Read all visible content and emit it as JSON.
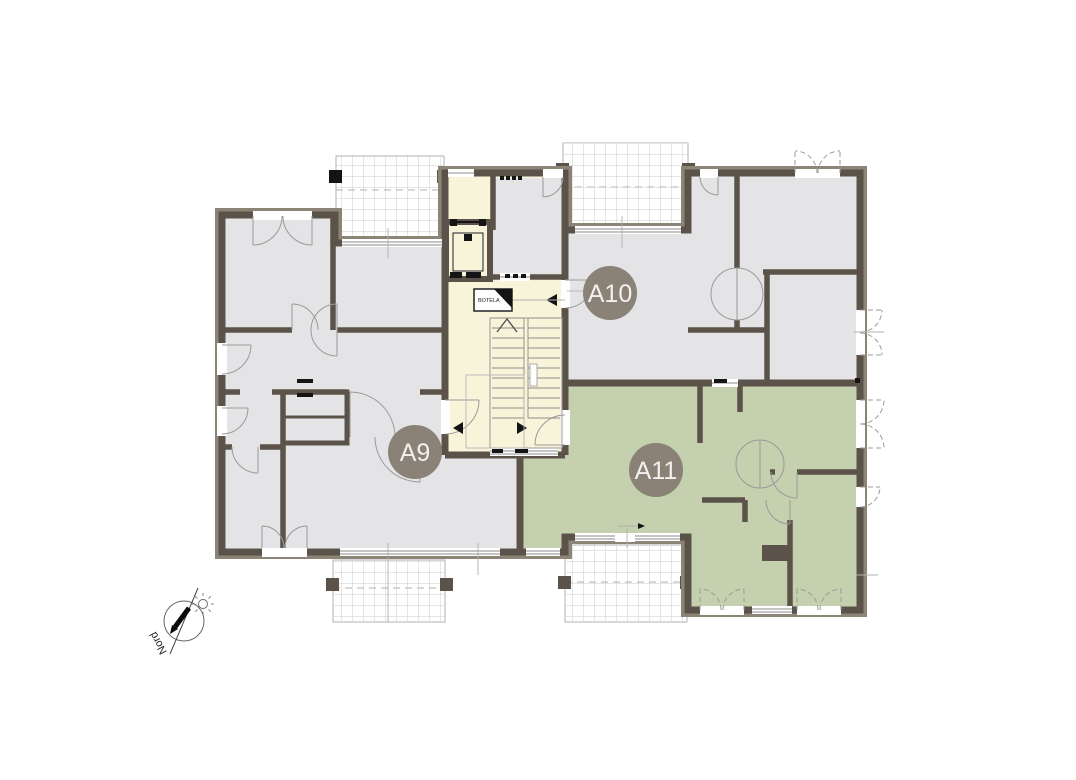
{
  "floor_plan": {
    "apartments": [
      {
        "id": "a9",
        "label": "A9",
        "fill": "#e4e4e6"
      },
      {
        "id": "a10",
        "label": "A10",
        "fill": "#e4e4e6"
      },
      {
        "id": "a11",
        "label": "A11",
        "fill": "#c5d0ae"
      }
    ],
    "core": {
      "mailbox_sign": "BOTELA",
      "fill": "#f8f4da"
    },
    "compass": {
      "north_label": "Nord"
    },
    "colors": {
      "wall": "#5b5349",
      "wall_outer_band": "#8d8478",
      "badge": "#8a8177",
      "badge_text": "#f2f1ee",
      "room_gray": "#e4e4e6",
      "room_green": "#c5d0ae",
      "core_cream": "#f8f4da",
      "door_line": "#9a9a9a",
      "balcony_grid": "#cccccc",
      "black_detail": "#141414"
    }
  }
}
